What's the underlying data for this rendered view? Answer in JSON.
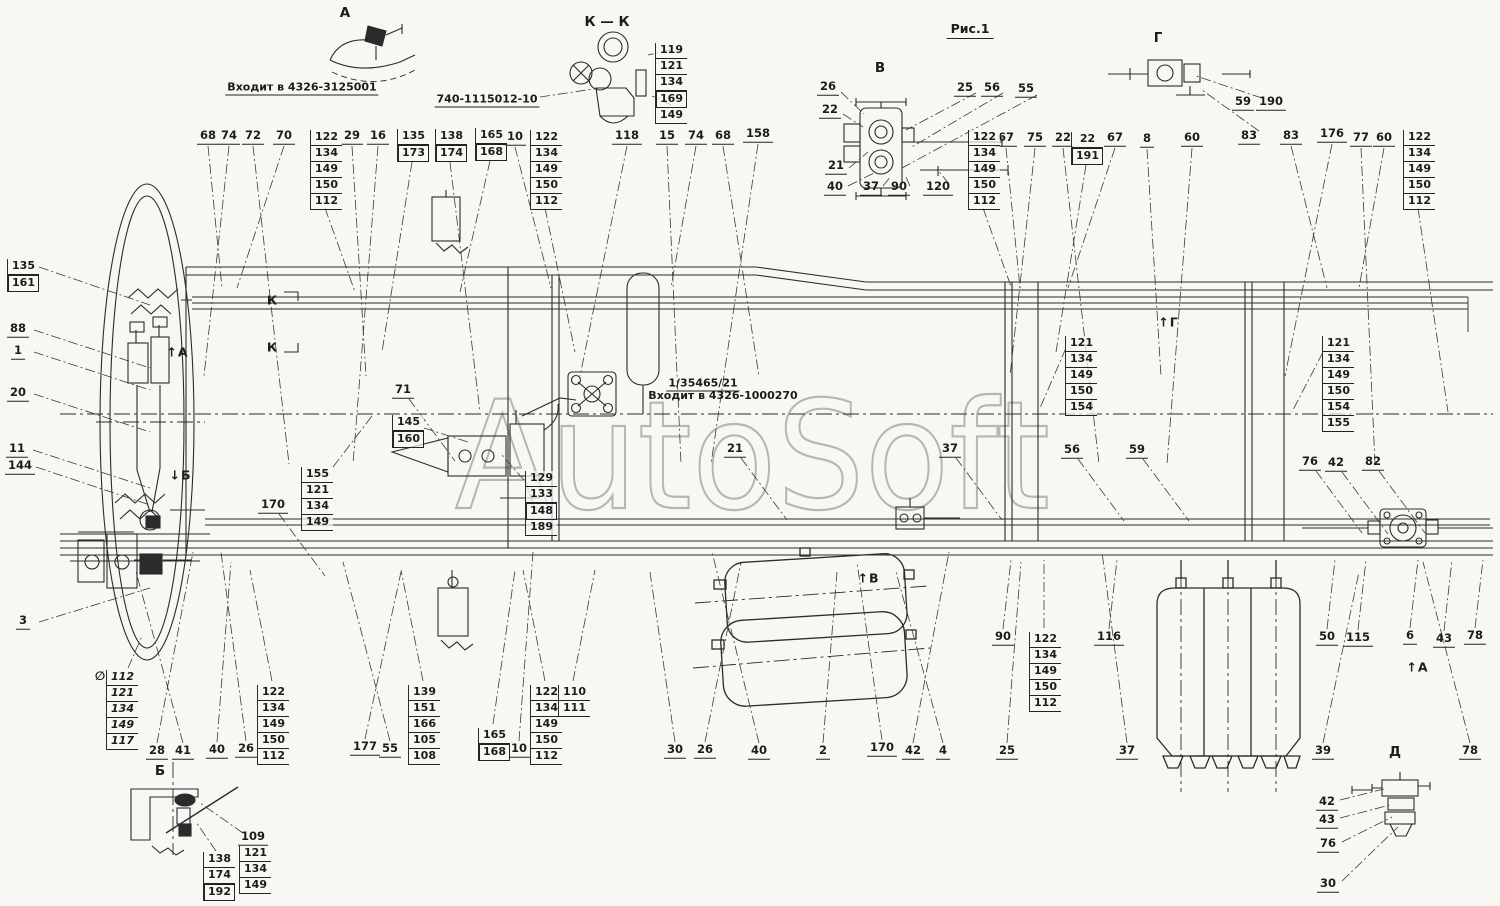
{
  "figure": {
    "caption": "Рис.1",
    "caption_x": 970,
    "caption_y": 30,
    "watermark": "AutoSoft"
  },
  "notes": [
    {
      "text": "Входит в 4326-3125001",
      "x": 302,
      "y": 88,
      "underline": true
    },
    {
      "text": "740-1115012-10",
      "x": 487,
      "y": 100,
      "underline": true
    },
    {
      "text": "1/35465/21",
      "x": 703,
      "y": 384,
      "underline": true
    },
    {
      "text": "Входит в 4326-1000270",
      "x": 723,
      "y": 396,
      "underline": false
    }
  ],
  "view_labels": [
    {
      "text": "А",
      "x": 345,
      "y": 13
    },
    {
      "text": "К — К",
      "x": 607,
      "y": 22
    },
    {
      "text": "В",
      "x": 880,
      "y": 68
    },
    {
      "text": "Г",
      "x": 1158,
      "y": 38
    },
    {
      "text": "Б",
      "x": 160,
      "y": 771
    },
    {
      "text": "Д",
      "x": 1395,
      "y": 752
    }
  ],
  "arrows": [
    {
      "letter": "А",
      "dir": "up",
      "x": 177,
      "y": 352
    },
    {
      "letter": "Б",
      "dir": "down",
      "x": 180,
      "y": 475
    },
    {
      "letter": "В",
      "dir": "up",
      "x": 868,
      "y": 578
    },
    {
      "letter": "Г",
      "dir": "up",
      "x": 1168,
      "y": 322
    },
    {
      "letter": "А",
      "dir": "up",
      "x": 1417,
      "y": 667
    }
  ],
  "section_marks": [
    {
      "text": "К",
      "x": 272,
      "y": 300
    },
    {
      "text": "К",
      "x": 272,
      "y": 347
    }
  ],
  "special_mark": {
    "text": "∅",
    "x": 100,
    "y": 676
  },
  "callouts": [
    {
      "t": "68",
      "x": 208,
      "y": 137,
      "z": "top"
    },
    {
      "t": "74",
      "x": 229,
      "y": 137,
      "z": "top"
    },
    {
      "t": "72",
      "x": 253,
      "y": 137,
      "z": "top"
    },
    {
      "t": "70",
      "x": 284,
      "y": 137,
      "z": "top"
    },
    {
      "t": "29",
      "x": 352,
      "y": 137,
      "z": "top"
    },
    {
      "t": "16",
      "x": 378,
      "y": 137,
      "z": "top"
    },
    {
      "t": "10",
      "x": 515,
      "y": 138,
      "z": "top"
    },
    {
      "t": "118",
      "x": 627,
      "y": 137,
      "z": "top"
    },
    {
      "t": "15",
      "x": 667,
      "y": 137,
      "z": "top"
    },
    {
      "t": "74",
      "x": 696,
      "y": 137,
      "z": "top"
    },
    {
      "t": "68",
      "x": 723,
      "y": 137,
      "z": "top"
    },
    {
      "t": "158",
      "x": 758,
      "y": 135,
      "z": "top"
    },
    {
      "t": "67",
      "x": 1006,
      "y": 139,
      "z": "top"
    },
    {
      "t": "75",
      "x": 1035,
      "y": 139,
      "z": "top"
    },
    {
      "t": "22",
      "x": 1063,
      "y": 139,
      "z": "top"
    },
    {
      "t": "67",
      "x": 1115,
      "y": 139,
      "z": "top"
    },
    {
      "t": "8",
      "x": 1147,
      "y": 140,
      "z": "top"
    },
    {
      "t": "60",
      "x": 1192,
      "y": 139,
      "z": "top"
    },
    {
      "t": "83",
      "x": 1291,
      "y": 137,
      "z": "top"
    },
    {
      "t": "176",
      "x": 1332,
      "y": 135,
      "z": "top"
    },
    {
      "t": "77",
      "x": 1361,
      "y": 139,
      "z": "top"
    },
    {
      "t": "60",
      "x": 1384,
      "y": 139,
      "z": "top"
    },
    {
      "t": "26",
      "x": 828,
      "y": 88,
      "z": "none"
    },
    {
      "t": "22",
      "x": 830,
      "y": 111,
      "z": "none"
    },
    {
      "t": "21",
      "x": 836,
      "y": 167,
      "z": "none"
    },
    {
      "t": "40",
      "x": 835,
      "y": 188,
      "z": "none"
    },
    {
      "t": "37",
      "x": 871,
      "y": 188,
      "z": "none"
    },
    {
      "t": "90",
      "x": 899,
      "y": 188,
      "z": "none"
    },
    {
      "t": "120",
      "x": 938,
      "y": 188,
      "z": "none"
    },
    {
      "t": "25",
      "x": 965,
      "y": 89,
      "z": "none"
    },
    {
      "t": "56",
      "x": 992,
      "y": 89,
      "z": "none"
    },
    {
      "t": "55",
      "x": 1026,
      "y": 90,
      "z": "none"
    },
    {
      "t": "59",
      "x": 1243,
      "y": 103,
      "z": "none"
    },
    {
      "t": "190",
      "x": 1271,
      "y": 103,
      "z": "none"
    },
    {
      "t": "83",
      "x": 1249,
      "y": 137,
      "z": "none"
    },
    {
      "t": "88",
      "x": 18,
      "y": 330,
      "z": "left"
    },
    {
      "t": "1",
      "x": 18,
      "y": 352,
      "z": "left"
    },
    {
      "t": "20",
      "x": 18,
      "y": 394,
      "z": "left"
    },
    {
      "t": "11",
      "x": 17,
      "y": 450,
      "z": "left"
    },
    {
      "t": "144",
      "x": 20,
      "y": 467,
      "z": "left"
    },
    {
      "t": "3",
      "x": 23,
      "y": 622,
      "z": "left"
    },
    {
      "t": "71",
      "x": 403,
      "y": 391,
      "z": "down"
    },
    {
      "t": "170",
      "x": 273,
      "y": 506,
      "z": "down"
    },
    {
      "t": "21",
      "x": 735,
      "y": 450,
      "z": "down"
    },
    {
      "t": "37",
      "x": 950,
      "y": 450,
      "z": "down"
    },
    {
      "t": "56",
      "x": 1072,
      "y": 451,
      "z": "down"
    },
    {
      "t": "59",
      "x": 1137,
      "y": 451,
      "z": "down"
    },
    {
      "t": "76",
      "x": 1310,
      "y": 463,
      "z": "down"
    },
    {
      "t": "42",
      "x": 1336,
      "y": 464,
      "z": "down"
    },
    {
      "t": "82",
      "x": 1373,
      "y": 463,
      "z": "down"
    },
    {
      "t": "28",
      "x": 157,
      "y": 752,
      "z": "bottom"
    },
    {
      "t": "41",
      "x": 183,
      "y": 752,
      "z": "bottom"
    },
    {
      "t": "40",
      "x": 217,
      "y": 751,
      "z": "bottom"
    },
    {
      "t": "26",
      "x": 246,
      "y": 750,
      "z": "bottom"
    },
    {
      "t": "177",
      "x": 365,
      "y": 748,
      "z": "bottom"
    },
    {
      "t": "55",
      "x": 390,
      "y": 750,
      "z": "bottom"
    },
    {
      "t": "10",
      "x": 519,
      "y": 750,
      "z": "bottom"
    },
    {
      "t": "30",
      "x": 675,
      "y": 751,
      "z": "bottom"
    },
    {
      "t": "26",
      "x": 705,
      "y": 751,
      "z": "bottom"
    },
    {
      "t": "40",
      "x": 759,
      "y": 752,
      "z": "bottom"
    },
    {
      "t": "2",
      "x": 823,
      "y": 752,
      "z": "bottom"
    },
    {
      "t": "170",
      "x": 882,
      "y": 749,
      "z": "bottom"
    },
    {
      "t": "42",
      "x": 913,
      "y": 752,
      "z": "bottom"
    },
    {
      "t": "4",
      "x": 943,
      "y": 752,
      "z": "bottom"
    },
    {
      "t": "25",
      "x": 1007,
      "y": 752,
      "z": "bottom"
    },
    {
      "t": "37",
      "x": 1127,
      "y": 752,
      "z": "bottom"
    },
    {
      "t": "39",
      "x": 1323,
      "y": 752,
      "z": "bottom"
    },
    {
      "t": "78",
      "x": 1470,
      "y": 752,
      "z": "bottom"
    },
    {
      "t": "90",
      "x": 1003,
      "y": 638,
      "z": "up"
    },
    {
      "t": "116",
      "x": 1109,
      "y": 638,
      "z": "up"
    },
    {
      "t": "50",
      "x": 1327,
      "y": 638,
      "z": "up"
    },
    {
      "t": "115",
      "x": 1358,
      "y": 639,
      "z": "up"
    },
    {
      "t": "6",
      "x": 1410,
      "y": 637,
      "z": "up"
    },
    {
      "t": "43",
      "x": 1444,
      "y": 640,
      "z": "up"
    },
    {
      "t": "78",
      "x": 1475,
      "y": 637,
      "z": "up"
    },
    {
      "t": "109",
      "x": 253,
      "y": 838,
      "z": "none"
    },
    {
      "t": "42",
      "x": 1327,
      "y": 803,
      "z": "none"
    },
    {
      "t": "43",
      "x": 1327,
      "y": 821,
      "z": "none"
    },
    {
      "t": "76",
      "x": 1328,
      "y": 845,
      "z": "none"
    },
    {
      "t": "30",
      "x": 1328,
      "y": 885,
      "z": "none"
    }
  ],
  "stacks": [
    {
      "x": 310,
      "y": 130,
      "v": [
        "122",
        "134",
        "149",
        "150",
        "112"
      ],
      "z": "top"
    },
    {
      "x": 397,
      "y": 129,
      "v": [
        "135",
        "173"
      ],
      "z": "top",
      "boxed": [
        1
      ]
    },
    {
      "x": 435,
      "y": 129,
      "v": [
        "138",
        "174"
      ],
      "z": "top",
      "boxed": [
        1
      ]
    },
    {
      "x": 475,
      "y": 128,
      "v": [
        "165",
        "168"
      ],
      "z": "top",
      "boxed": [
        1
      ]
    },
    {
      "x": 530,
      "y": 130,
      "v": [
        "122",
        "134",
        "149",
        "150",
        "112"
      ],
      "z": "top"
    },
    {
      "x": 655,
      "y": 43,
      "v": [
        "119",
        "121",
        "134",
        "169",
        "149"
      ],
      "z": "none",
      "boxed": [
        3
      ]
    },
    {
      "x": 968,
      "y": 130,
      "v": [
        "122",
        "134",
        "149",
        "150",
        "112"
      ],
      "z": "top"
    },
    {
      "x": 1071,
      "y": 132,
      "v": [
        "22",
        "191"
      ],
      "z": "top",
      "boxed": [
        1
      ]
    },
    {
      "x": 1403,
      "y": 130,
      "v": [
        "122",
        "134",
        "149",
        "150",
        "112"
      ],
      "z": "top"
    },
    {
      "x": 7,
      "y": 259,
      "v": [
        "135",
        "161"
      ],
      "z": "left",
      "boxed": [
        1
      ]
    },
    {
      "x": 106,
      "y": 670,
      "v": [
        "112",
        "121",
        "134",
        "149",
        "117"
      ],
      "z": "none",
      "italic": true
    },
    {
      "x": 257,
      "y": 685,
      "v": [
        "122",
        "134",
        "149",
        "150",
        "112"
      ],
      "z": "bottom"
    },
    {
      "x": 301,
      "y": 467,
      "v": [
        "155",
        "121",
        "134",
        "149"
      ],
      "z": "none"
    },
    {
      "x": 392,
      "y": 415,
      "v": [
        "145",
        "160"
      ],
      "z": "none",
      "boxed": [
        1
      ]
    },
    {
      "x": 525,
      "y": 471,
      "v": [
        "129",
        "133",
        "148",
        "189"
      ],
      "z": "none",
      "boxed": [
        2
      ]
    },
    {
      "x": 1065,
      "y": 336,
      "v": [
        "121",
        "134",
        "149",
        "150",
        "154"
      ],
      "z": "none"
    },
    {
      "x": 1322,
      "y": 336,
      "v": [
        "121",
        "134",
        "149",
        "150",
        "154",
        "155"
      ],
      "z": "none"
    },
    {
      "x": 408,
      "y": 685,
      "v": [
        "139",
        "151",
        "166",
        "105",
        "108"
      ],
      "z": "bottom"
    },
    {
      "x": 478,
      "y": 728,
      "v": [
        "165",
        "168"
      ],
      "z": "bottom",
      "boxed": [
        1
      ]
    },
    {
      "x": 530,
      "y": 685,
      "v": [
        "122",
        "134",
        "149",
        "150",
        "112"
      ],
      "z": "bottom"
    },
    {
      "x": 558,
      "y": 685,
      "v": [
        "110",
        "111"
      ],
      "z": "bottom"
    },
    {
      "x": 1029,
      "y": 632,
      "v": [
        "122",
        "134",
        "149",
        "150",
        "112"
      ],
      "z": "up"
    },
    {
      "x": 239,
      "y": 846,
      "v": [
        "121",
        "134",
        "149"
      ],
      "z": "none"
    },
    {
      "x": 203,
      "y": 852,
      "v": [
        "138",
        "174",
        "192"
      ],
      "z": "none",
      "boxed": [
        2
      ]
    }
  ]
}
